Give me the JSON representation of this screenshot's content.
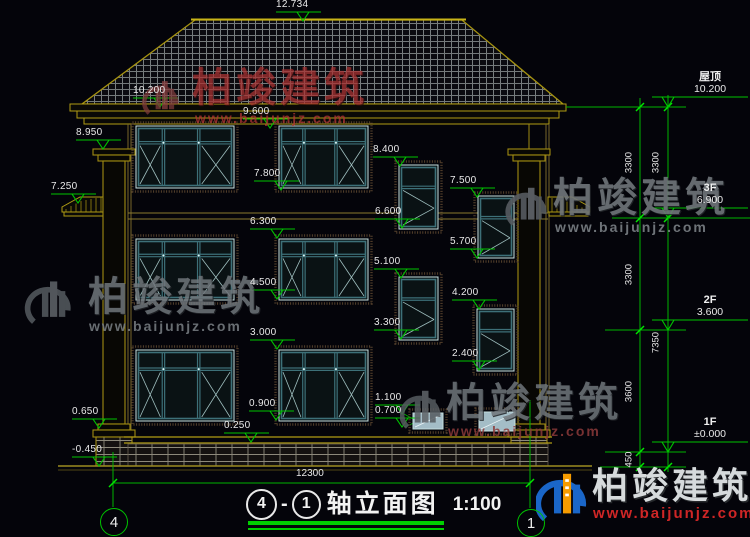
{
  "title_block": {
    "axis_start": "4",
    "separator": "-",
    "axis_end": "1",
    "title": "轴立面图",
    "scale": "1:100"
  },
  "axis_bubbles": {
    "left": "4",
    "right": "1"
  },
  "watermark": {
    "company": "柏竣建筑",
    "website": "www.baijunjz.com"
  },
  "elevation_markers": [
    {
      "label": "12.734",
      "x": 303,
      "y": 21
    },
    {
      "label": "10.200",
      "x": 160,
      "y": 107
    },
    {
      "label": "9.600",
      "x": 270,
      "y": 128
    },
    {
      "label": "8.950",
      "x": 103,
      "y": 149
    },
    {
      "label": "8.400",
      "x": 400,
      "y": 166
    },
    {
      "label": "7.800",
      "x": 281,
      "y": 190
    },
    {
      "label": "7.500",
      "x": 477,
      "y": 197
    },
    {
      "label": "7.250",
      "x": 78,
      "y": 203
    },
    {
      "label": "6.600",
      "x": 402,
      "y": 228
    },
    {
      "label": "6.300",
      "x": 277,
      "y": 238
    },
    {
      "label": "5.700",
      "x": 477,
      "y": 258
    },
    {
      "label": "5.100",
      "x": 401,
      "y": 278
    },
    {
      "label": "4.500",
      "x": 277,
      "y": 299
    },
    {
      "label": "4.200",
      "x": 479,
      "y": 309
    },
    {
      "label": "3.300",
      "x": 401,
      "y": 339
    },
    {
      "label": "3.000",
      "x": 277,
      "y": 349
    },
    {
      "label": "2.400",
      "x": 479,
      "y": 370
    },
    {
      "label": "1.100",
      "x": 402,
      "y": 414
    },
    {
      "label": "0.900",
      "x": 276,
      "y": 420
    },
    {
      "label": "0.700",
      "x": 402,
      "y": 427
    },
    {
      "label": "0.650",
      "x": 99,
      "y": 428
    },
    {
      "label": "0.250",
      "x": 251,
      "y": 442
    },
    {
      "label": "-0.450",
      "x": 99,
      "y": 466
    }
  ],
  "floor_markers": [
    {
      "label": "屋顶",
      "value": "10.200",
      "y": 107
    },
    {
      "label": "3F",
      "value": "6.900",
      "y": 218
    },
    {
      "label": "2F",
      "value": "3.600",
      "y": 330
    },
    {
      "label": "1F",
      "value": "±0.000",
      "y": 452
    }
  ],
  "dimensions": {
    "right_outer": [
      {
        "label": "3300",
        "y": 162
      },
      {
        "label": "3300",
        "y": 274
      },
      {
        "label": "3600",
        "y": 391
      },
      {
        "label": "450",
        "y": 459
      }
    ],
    "right_inner": [
      {
        "label": "3300",
        "y": 162
      },
      {
        "label": "7350",
        "y": 342
      }
    ],
    "bottom": {
      "label": "12300"
    }
  },
  "colors": {
    "marker_green": "#00c300",
    "outline_yellow": "#a69310",
    "window_teal": "#3d7078",
    "watermark_red": "#a93232",
    "watermark_gray": "#70767b",
    "background": "#04040a"
  }
}
